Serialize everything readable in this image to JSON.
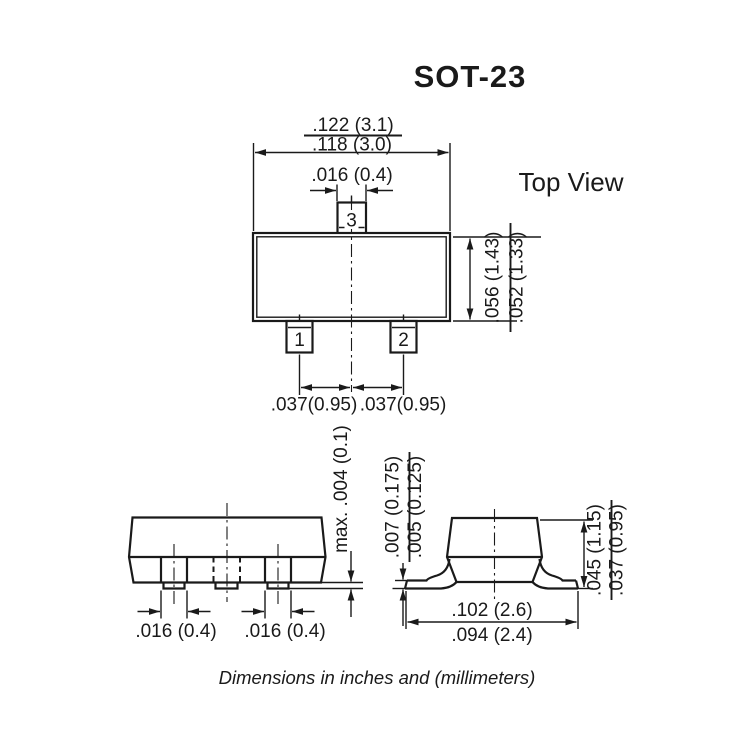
{
  "title": "SOT-23",
  "caption": "Dimensions in inches and (millimeters)",
  "colors": {
    "line": "#1a1a1a",
    "background": "#ffffff"
  },
  "top_view": {
    "label": "Top View",
    "pin1": "1",
    "pin2": "2",
    "pin3": "3",
    "body_width_max": ".122 (3.1)",
    "body_width_min": ".118 (3.0)",
    "pin3_width": ".016 (0.4)",
    "body_depth_max": ".056 (1.43)",
    "body_depth_min": ".052 (1.33)",
    "pitch_left": ".037(0.95)",
    "pitch_right": ".037(0.95)"
  },
  "front_view": {
    "lead_width_left": ".016 (0.4)",
    "lead_width_right": ".016 (0.4)",
    "standoff_max": "max. .004 (0.1)"
  },
  "side_view": {
    "lead_thickness_max": ".007 (0.175)",
    "lead_thickness_min": ".005 (0.125)",
    "height_max": ".045 (1.15)",
    "height_min": ".037 (0.95)",
    "span_max": ".102 (2.6)",
    "span_min": ".094 (2.4)"
  }
}
